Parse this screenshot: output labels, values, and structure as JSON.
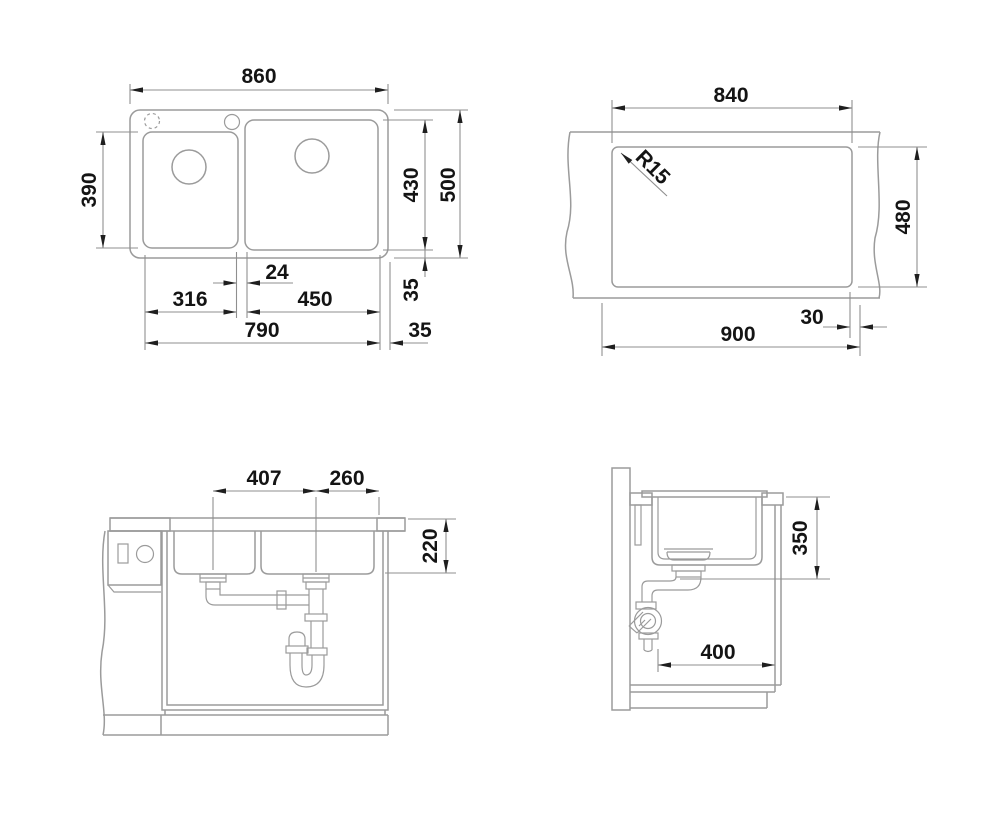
{
  "document": {
    "kind": "sink installation drawing",
    "views": {
      "plan": {
        "labels": {
          "overall_width": "860",
          "left_bowl_depth": "390",
          "right_bowl_depth": "430",
          "overall_depth": "500",
          "bowl_gap": "24",
          "left_bowl_width": "316",
          "right_bowl_width": "450",
          "bowls_total_width": "790",
          "rear_margin": "35",
          "side_margin": "35"
        }
      },
      "cutout": {
        "labels": {
          "cutout_width": "840",
          "corner_radius": "R15",
          "cutout_depth": "480",
          "min_cabinet_width": "900",
          "edge_margin": "30"
        }
      },
      "front_section": {
        "labels": {
          "drain_spacing": "407",
          "drain_to_edge": "260",
          "bowl_height": "220"
        }
      },
      "side_section": {
        "labels": {
          "clearance_height": "350",
          "clearance_depth": "400"
        }
      }
    }
  },
  "colors": {
    "background": "#ffffff",
    "drawing_line": "#9b9b9b",
    "arrow": "#1f1f1f",
    "text": "#141414"
  }
}
